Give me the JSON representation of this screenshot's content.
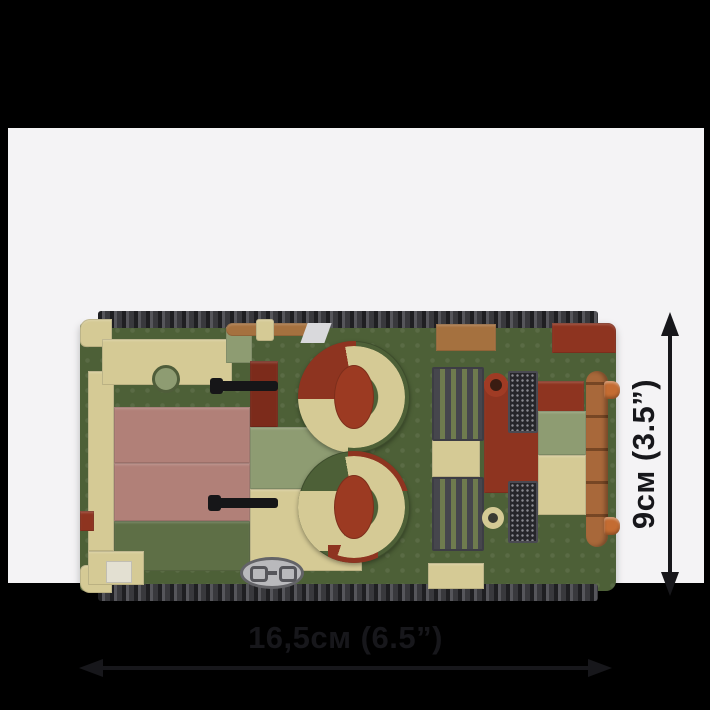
{
  "image": {
    "alt": "Top view of a COBI brick-built tank model in green, tan, mauve and dark-red camouflage, shown with its width and length dimensions"
  },
  "dimensions": {
    "width_label": "16,5см (6.5”)",
    "height_label": "9см (3.5”)"
  },
  "colors": {
    "bg": "#000000",
    "panel": "#f4f3f5",
    "ink": "#17171b",
    "green_dark": "#4d6037",
    "green_mid": "#5e6f46",
    "sage": "#8e9c72",
    "tan": "#d5ca95",
    "mauve": "#b18078",
    "red_dark": "#8e3420",
    "red_brick": "#7c2b1b",
    "brown": "#a5713f",
    "log_brown": "#a8683a",
    "copper": "#c46c32",
    "track": "#3a3a3e",
    "metal": "#b9b9bc"
  }
}
